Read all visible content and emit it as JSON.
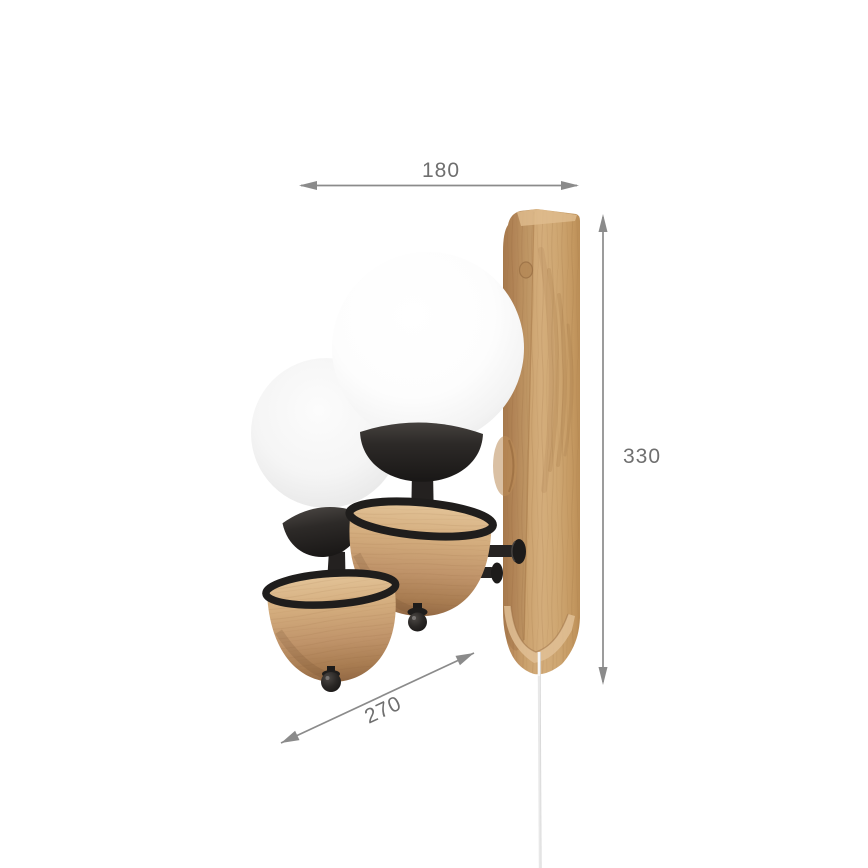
{
  "background": "#ffffff",
  "dimensions": {
    "width": {
      "label": "180"
    },
    "height": {
      "label": "330"
    },
    "depth": {
      "label": "270"
    },
    "line_color": "#8b8b8b",
    "label_color": "#6f6f6f"
  },
  "product": {
    "description": "wall sconce with two white opal globes, black metal sockets, wooden cups and wooden wall backplate",
    "parts": {
      "backplate": {
        "name": "wood-backplate",
        "color": "#cda572"
      },
      "globe_front": {
        "name": "opal-glass-globe-front",
        "color": "#fbfbfb"
      },
      "globe_rear": {
        "name": "opal-glass-globe-rear",
        "color": "#f4f4f4"
      },
      "sockets": {
        "name": "black-metal-socket",
        "color": "#242120"
      },
      "cups": {
        "name": "wood-cup",
        "color": "#c9a171"
      },
      "rings": {
        "name": "black-metal-ring",
        "color": "#1f1d1c"
      },
      "finials": {
        "name": "black-finial-ball",
        "color": "#1d1b1a"
      },
      "wall_mounts": {
        "name": "black-wall-pivot",
        "color": "#1f1d1c"
      },
      "cord": {
        "name": "pull-cord",
        "color": "#e6e6e6"
      }
    }
  }
}
